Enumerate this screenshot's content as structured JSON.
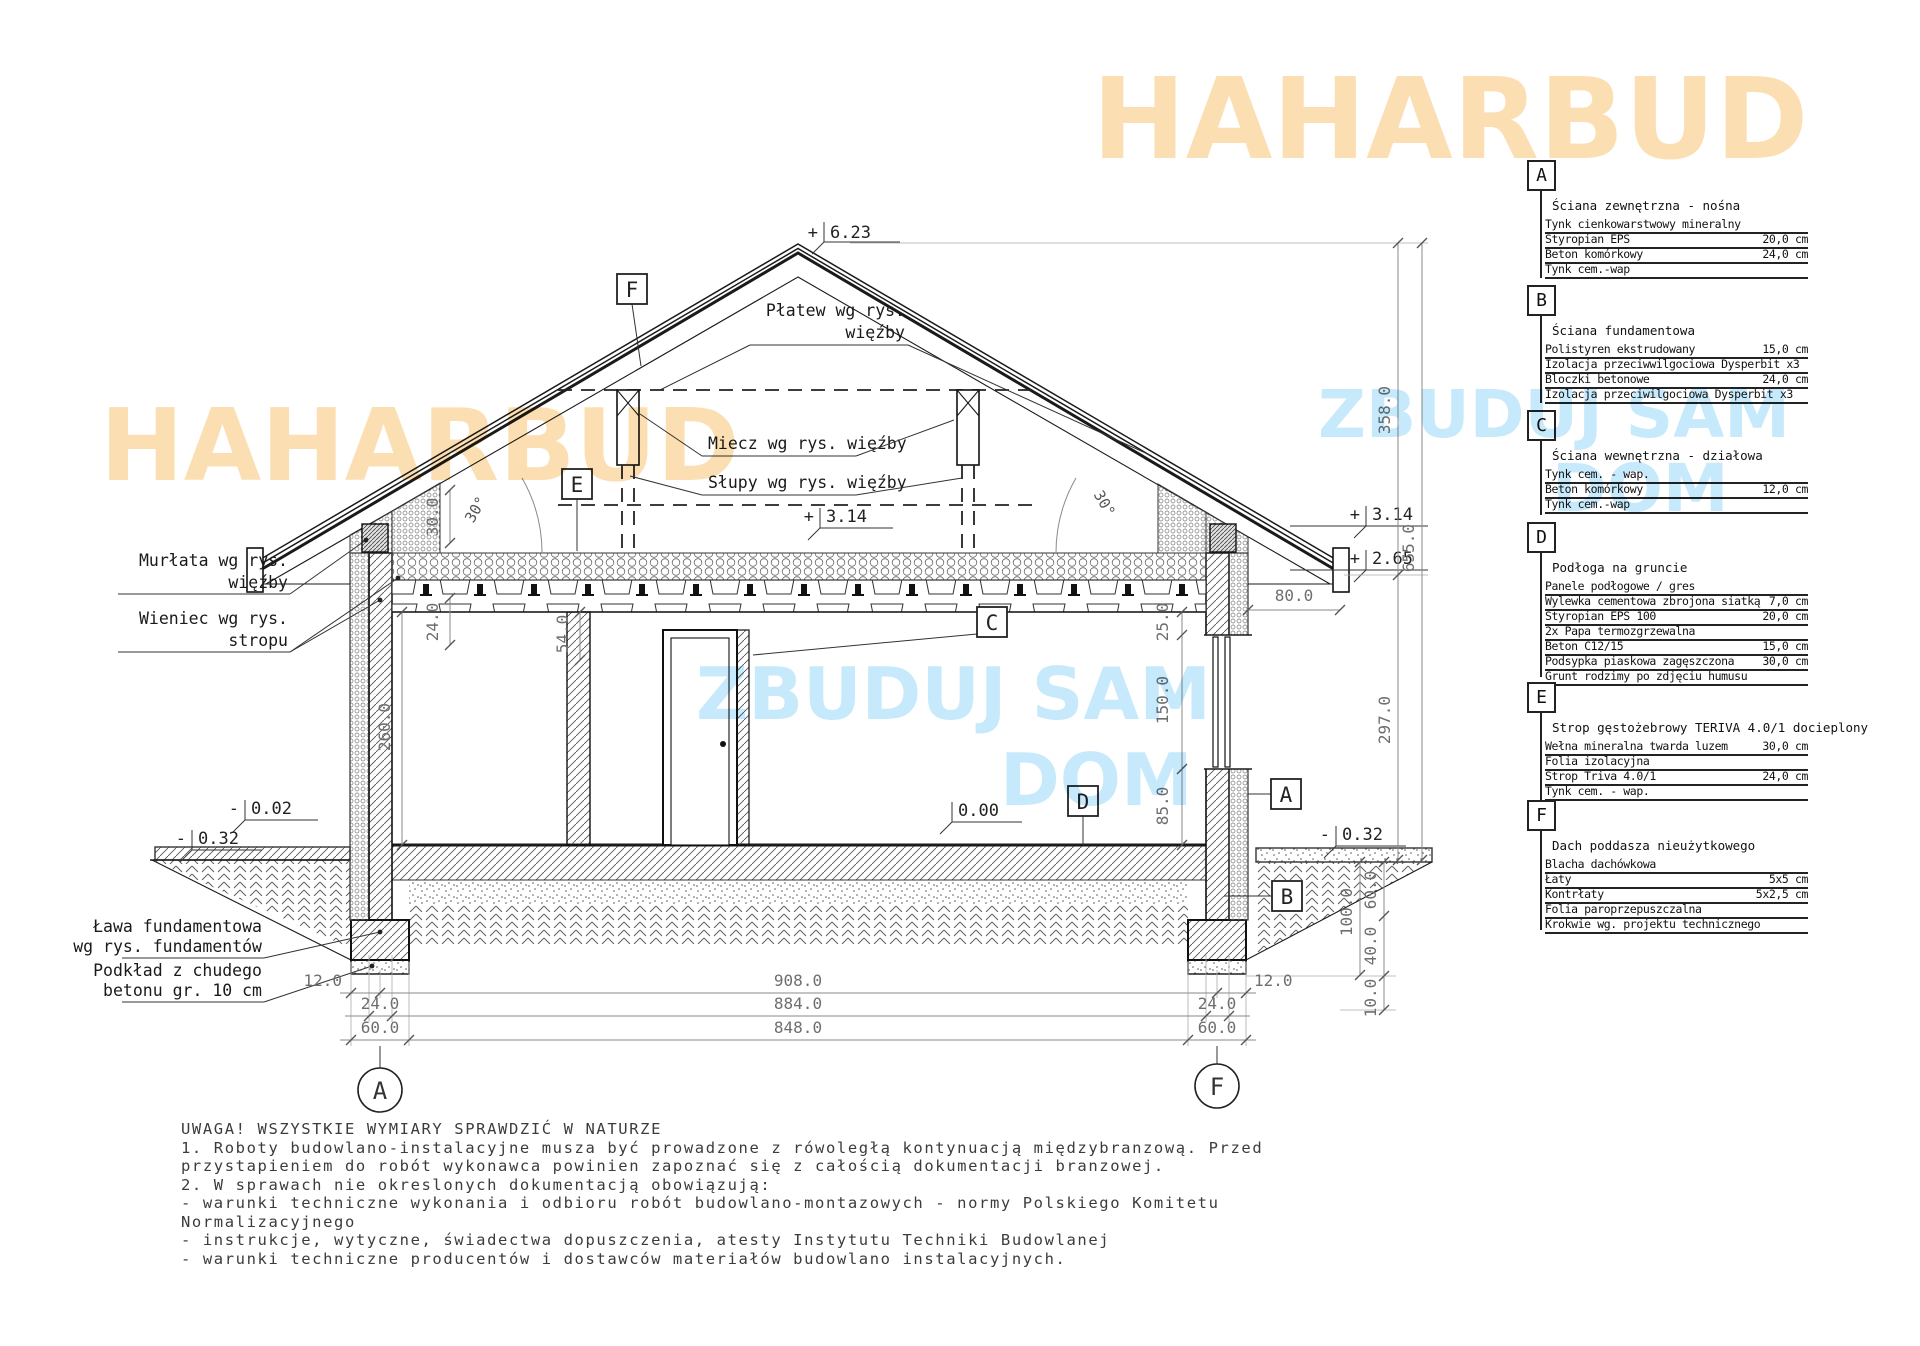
{
  "watermarks": {
    "brand": "HAHARBUD",
    "zbuduj": "ZBUDUJ SAM",
    "dom": "DOM",
    "orange": "#fbdfb2",
    "blue": "#c7e9fc"
  },
  "legend": {
    "sections": [
      {
        "key": "A",
        "title": "Ściana zewnętrzna - nośna",
        "rows": [
          {
            "name": "Tynk cienkowarstwowy mineralny",
            "value": ""
          },
          {
            "name": "Styropian EPS",
            "value": "20,0 cm"
          },
          {
            "name": "Beton komórkowy",
            "value": "24,0 cm"
          },
          {
            "name": "Tynk cem.-wap",
            "value": ""
          }
        ]
      },
      {
        "key": "B",
        "title": "Ściana fundamentowa",
        "rows": [
          {
            "name": "Polistyren ekstrudowany",
            "value": "15,0 cm"
          },
          {
            "name": "Izolacja przeciwwilgociowa Dysperbit x3",
            "value": ""
          },
          {
            "name": "Bloczki betonowe",
            "value": "24,0 cm"
          },
          {
            "name": "Izolacja przeciwilgociowa Dysperbit x3",
            "value": ""
          }
        ]
      },
      {
        "key": "C",
        "title": "Ściana wewnętrzna - działowa",
        "rows": [
          {
            "name": "Tynk cem. - wap.",
            "value": ""
          },
          {
            "name": "Beton komórkowy",
            "value": "12,0 cm"
          },
          {
            "name": "Tynk cem.-wap",
            "value": ""
          }
        ]
      },
      {
        "key": "D",
        "title": "Podłoga na gruncie",
        "rows": [
          {
            "name": "Panele podłogowe / gres",
            "value": ""
          },
          {
            "name": "Wylewka cementowa zbrojona siatką",
            "value": "7,0 cm"
          },
          {
            "name": "Styropian EPS 100",
            "value": "20,0 cm"
          },
          {
            "name": "2x Papa termozgrzewalna",
            "value": ""
          },
          {
            "name": "Beton C12/15",
            "value": "15,0 cm"
          },
          {
            "name": "Podsypka piaskowa zagęszczona",
            "value": "30,0 cm"
          },
          {
            "name": "Grunt rodzimy po zdjęciu humusu",
            "value": ""
          }
        ]
      },
      {
        "key": "E",
        "title": "Strop gęstożebrowy TERIVA 4.0/1 docieplony",
        "rows": [
          {
            "name": "Wełna mineralna twarda luzem",
            "value": "30,0 cm"
          },
          {
            "name": "Folia izolacyjna",
            "value": ""
          },
          {
            "name": "Strop Triva 4.0/1",
            "value": "24,0 cm"
          },
          {
            "name": "Tynk cem. - wap.",
            "value": ""
          }
        ]
      },
      {
        "key": "F",
        "title": "Dach poddasza nieużytkowego",
        "rows": [
          {
            "name": "Blacha dachówkowa",
            "value": ""
          },
          {
            "name": "Łaty",
            "value": "5x5 cm"
          },
          {
            "name": "Kontrłaty",
            "value": "5x2,5 cm"
          },
          {
            "name": "Folia paroprzepuszczalna",
            "value": ""
          },
          {
            "name": "Krokwie wg. projektu technicznego",
            "value": ""
          }
        ]
      }
    ]
  },
  "drawing": {
    "levels": {
      "ridge": {
        "sign": "+",
        "value": "6.23"
      },
      "attic_mid": {
        "sign": "+",
        "value": "3.14"
      },
      "attic_right": {
        "sign": "+",
        "value": "3.14"
      },
      "eaves_right": {
        "sign": "+",
        "value": "2.65"
      },
      "terrace": {
        "sign": "-",
        "value": "0.02"
      },
      "terrain_left": {
        "sign": "-",
        "value": "0.32"
      },
      "floor": {
        "sign": "",
        "value": "0.00"
      },
      "terrain_right": {
        "sign": "-",
        "value": "0.32"
      }
    },
    "angles": {
      "left": "30°",
      "right": "30°"
    },
    "labels": {
      "platew_1": "Płatew wg rys.",
      "platew_2": "więźby",
      "miecz": "Miecz wg rys. więźby",
      "slupy": "Słupy wg rys. więźby",
      "murlata_1": "Murłata wg rys.",
      "murlata_2": "więźby",
      "wieniec_1": "Wieniec wg rys.",
      "wieniec_2": "stropu",
      "lawa_1": "Ława fundamentowa",
      "lawa_2": "wg rys. fundamentów",
      "podklad_1": "Podkład z chudego",
      "podklad_2": "betonu gr. 10 cm"
    },
    "markers": {
      "a": "A",
      "b": "B",
      "c": "C",
      "d": "D",
      "e": "E",
      "f": "F"
    },
    "axes": {
      "left": "A",
      "right": "F"
    },
    "dims": {
      "roof_h": "358.0",
      "total_h": "655.0",
      "wall_h": "297.0",
      "eaves_a": "30.0",
      "eaves_b": "24.0",
      "beam": "54.0",
      "room": "260.0",
      "over_win": "25.0",
      "win": "150.0",
      "sill": "85.0",
      "overhang": "80.0",
      "found_total": "100.0",
      "found_a": "60.0",
      "found_b": "40.0",
      "podklad": "10.0",
      "half_l": "12.0",
      "half_r": "12.0",
      "wall_l": "24.0",
      "wall_r": "24.0",
      "foot_l": "60.0",
      "foot_r": "60.0",
      "span1": "908.0",
      "span2": "884.0",
      "span3": "848.0"
    }
  },
  "notes": {
    "title": "UWAGA! WSZYSTKIE WYMIARY SPRAWDZIĆ W NATURZE",
    "lines": [
      "1. Roboty budowlano-instalacyjne musza być prowadzone z rówoległą kontynuacją międzybranzową. Przed",
      "przystapieniem do robót wykonawca powinien zapoznać się z całością dokumentacji branzowej.",
      "2. W sprawach nie okreslonych dokumentacją obowiązują:",
      "- warunki techniczne wykonania i odbioru robót budowlano-montazowych - normy Polskiego Komitetu",
      "Normalizacyjnego",
      "- instrukcje, wytyczne, świadectwa dopuszczenia, atesty Instytutu Techniki Budowlanej",
      "- warunki techniczne producentów i dostawców materiałów budowlano instalacyjnych."
    ]
  }
}
